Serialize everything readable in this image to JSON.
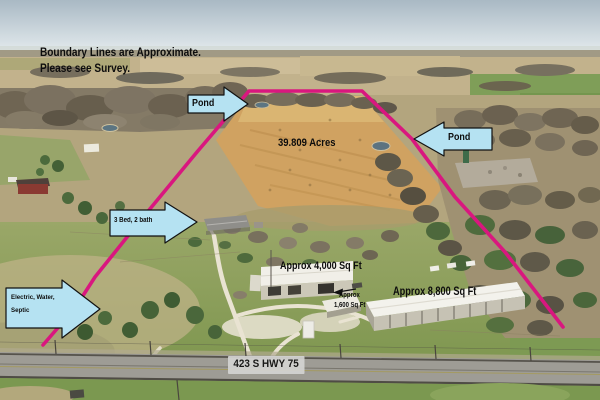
{
  "disclaimer": {
    "line1": "Boundary Lines are Approximate.",
    "line2": "Please see Survey."
  },
  "field": {
    "acreage_label": "39.809 Acres"
  },
  "callouts": {
    "pond_west": "Pond",
    "pond_east": "Pond",
    "bed_bath": "3 Bed, 2 bath",
    "utilities_line1": "Electric, Water,",
    "utilities_line2": "Septic"
  },
  "buildings": {
    "shop_label": "Approx 4,000 Sq Ft",
    "warehouse_label": "Approx 8,800 Sq Ft",
    "shed_label_line1": "Approx",
    "shed_label_line2": "1,600 Sq Ft"
  },
  "road": {
    "address": "423 S HWY 75"
  },
  "colors": {
    "boundary_line": "#d9177f",
    "callout_fill": "#b5e2f2",
    "callout_border": "#121212",
    "annotation_text": "#0d0d0d",
    "address_badge_bg": "#d4d4d2"
  }
}
